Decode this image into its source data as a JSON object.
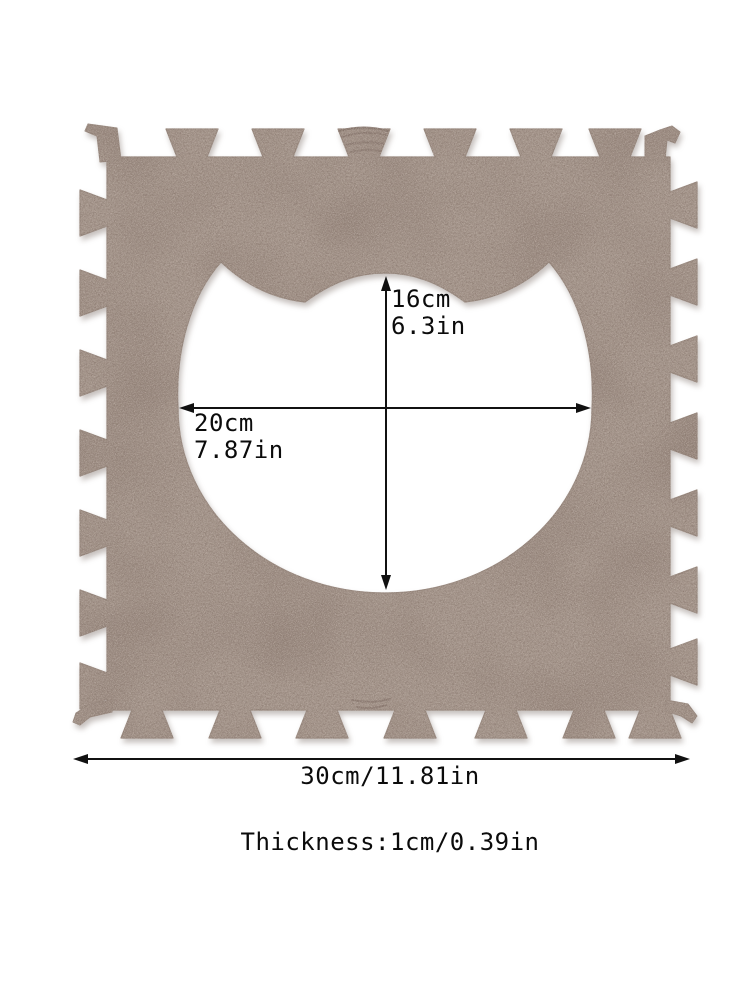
{
  "diagram": {
    "title": "foam-puzzle-mat-dimension-diagram",
    "background": "#ffffff"
  },
  "mat": {
    "description": "interlocking felt foam puzzle mat tile with cat-head cutout",
    "colors": {
      "base": "#a5968c",
      "speckle_dark": "#8b7a70",
      "speckle_light": "#c6b8af",
      "edge": "#97887e"
    }
  },
  "dimensions": {
    "cutout_height_cm": "16cm",
    "cutout_height_in": "6.3in",
    "cutout_width_cm": "20cm",
    "cutout_width_in": "7.87in",
    "mat_width": "30cm/11.81in",
    "thickness": "Thickness:1cm/0.39in"
  }
}
